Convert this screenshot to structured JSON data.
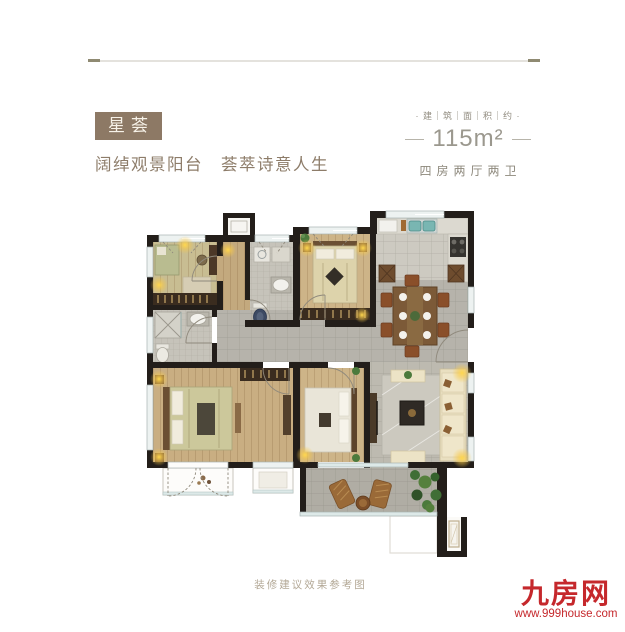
{
  "header": {
    "badge": "星荟",
    "tagline": "阔绰观景阳台　荟萃诗意人生",
    "area": {
      "label": "· 建｜筑｜面｜积｜约 ·",
      "value": "115m²",
      "unit_type": "四房两厅两卫"
    }
  },
  "floorplan": {
    "caption": "装修建议效果参考图"
  },
  "brand": {
    "logo": "九房网",
    "website": "www.999house.com"
  },
  "colors": {
    "badge_brown": "#8d7965",
    "text_brown": "#8d7c69",
    "muted_gray": "#9b988e",
    "logo_red": "#c5282c",
    "wall_black": "#231e1a",
    "lamp_gold": "#f5c64a"
  }
}
